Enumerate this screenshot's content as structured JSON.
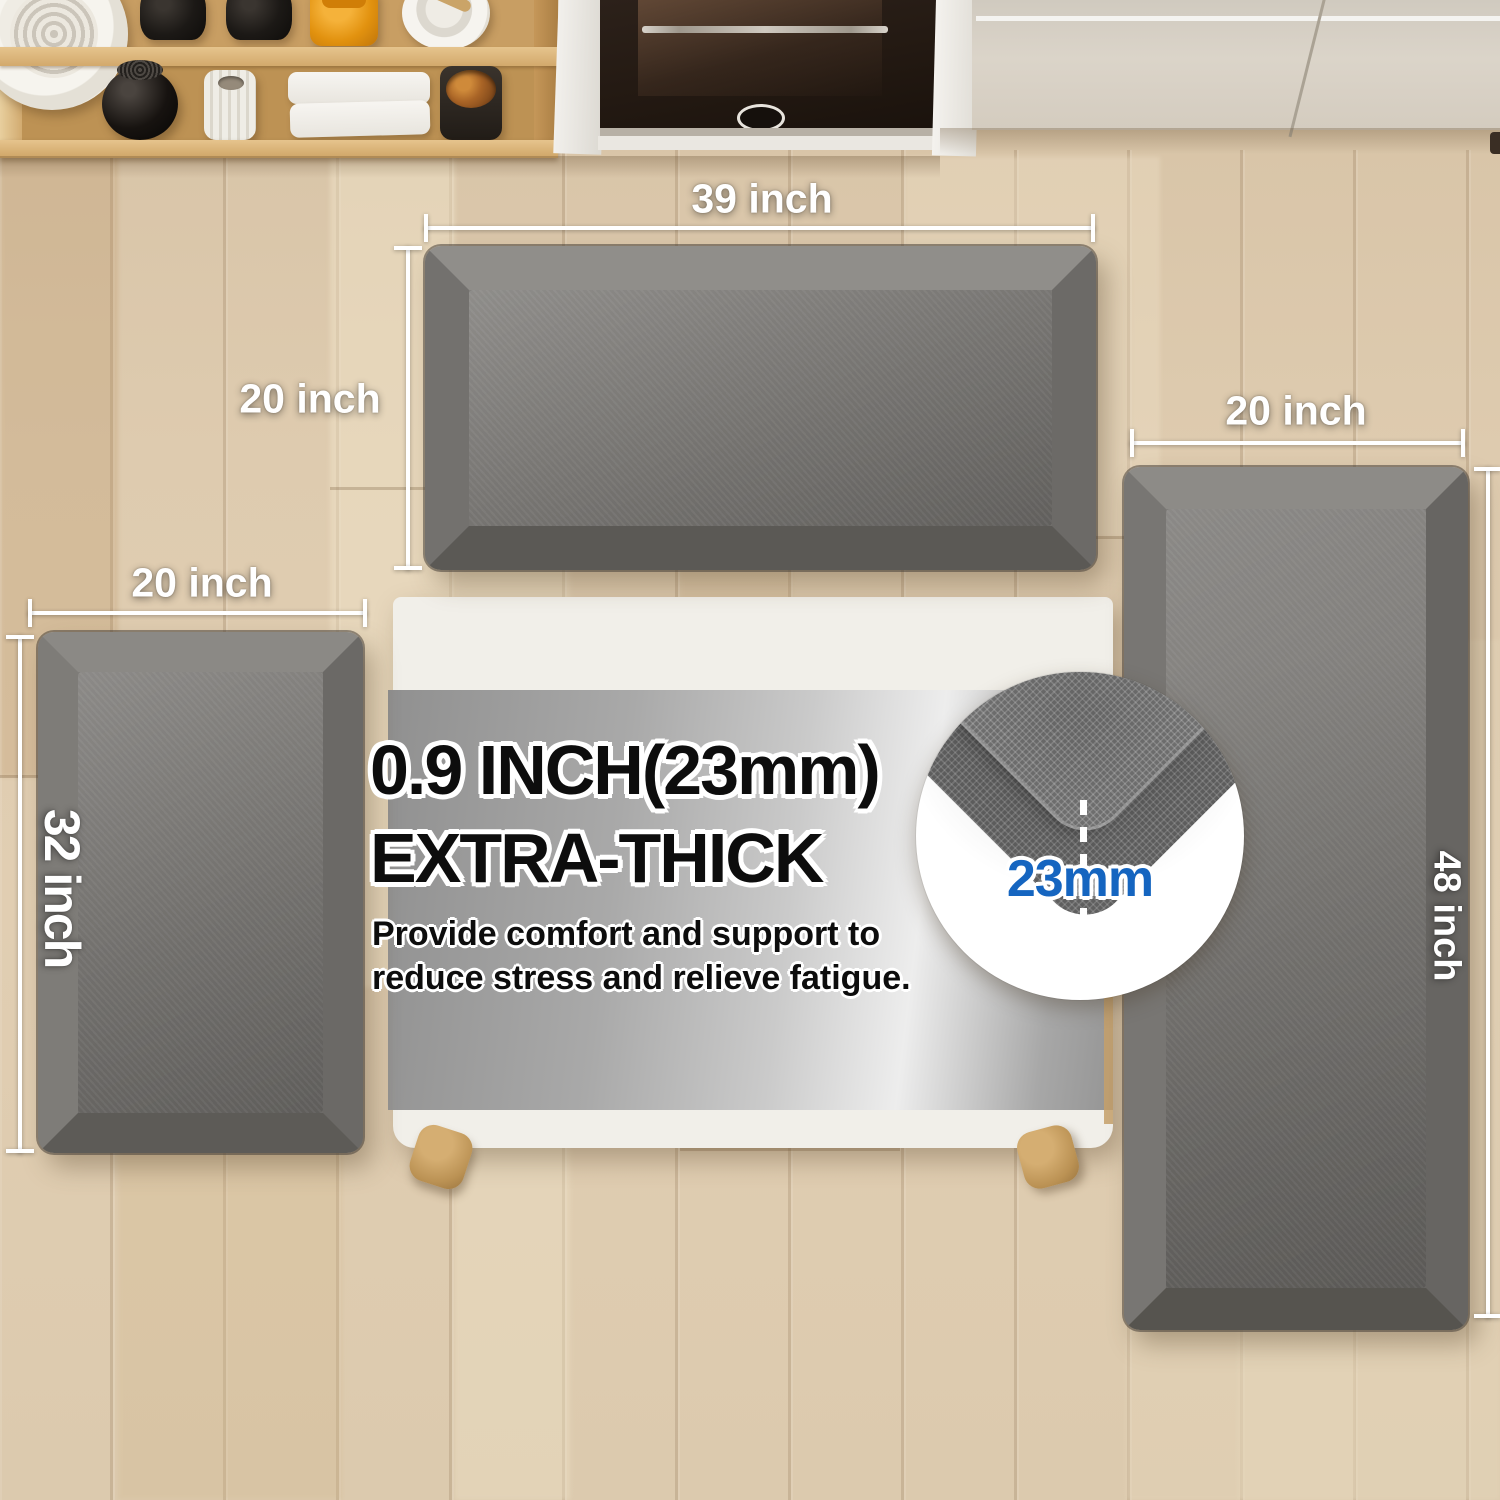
{
  "labels": {
    "top_mat_width": "39 inch",
    "top_mat_depth": "20 inch",
    "left_mat_width": "20 inch",
    "left_mat_length": "32 inch",
    "right_mat_width": "20 inch",
    "right_mat_length": "48 inch"
  },
  "callout": {
    "headline_line1": "0.9 INCH(23mm)",
    "headline_line2": "EXTRA-THICK",
    "body_line1": "Provide comfort and support to",
    "body_line2": "reduce stress and relieve fatigue.",
    "badge_value": "23mm"
  },
  "colors": {
    "badge_blue": "#1565c0",
    "mat_surface": "#7b7977",
    "mat_bevel_light": "#8e8c89",
    "mat_bevel_dark": "#585653",
    "floor_wood": "#dbc8ac",
    "shelf_wood": "#c89e63",
    "cabinet_white": "#d8d1c6",
    "table_white": "#f1efe9",
    "annotation_white": "#ffffff"
  }
}
